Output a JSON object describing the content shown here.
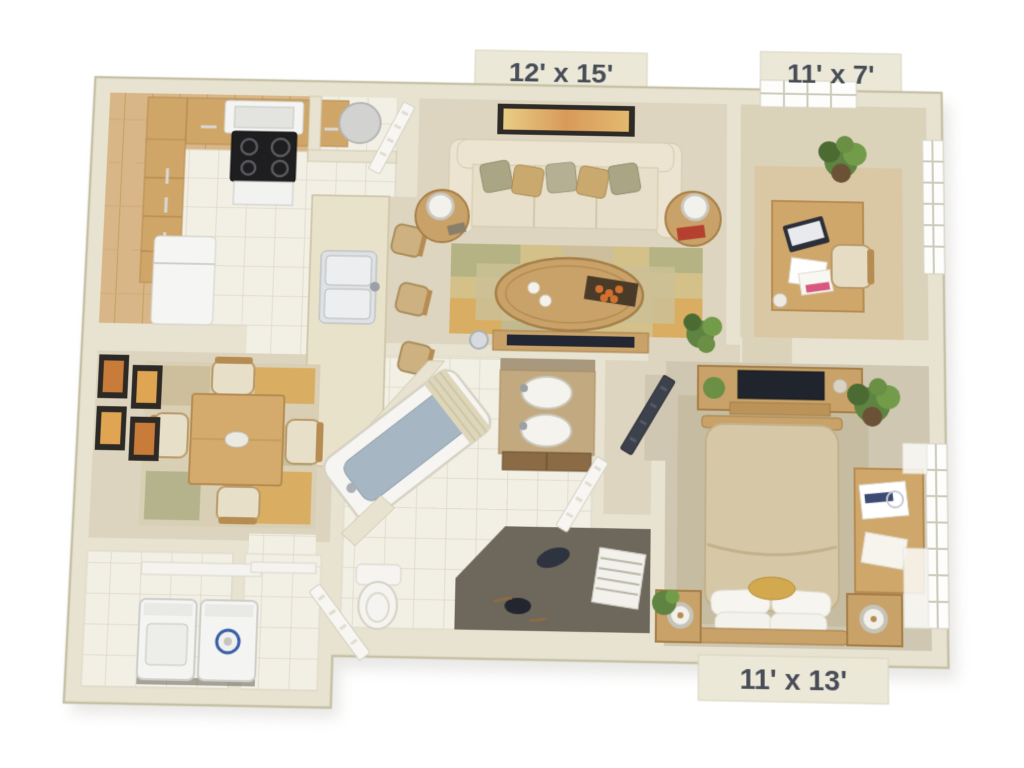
{
  "floorplan": {
    "type": "3d-apartment-floor-plan",
    "labels": {
      "living_room": "12' x 15'",
      "den": "11' x 7'",
      "bedroom": "11' x 13'"
    },
    "rooms": [
      "kitchen",
      "living-room",
      "den-office",
      "dining-room",
      "bathroom",
      "walk-in-closet",
      "bedroom",
      "laundry-room",
      "entry-hall"
    ],
    "colors": {
      "background": "#ffffff",
      "wall": "#e7e3d0",
      "wall_edge": "#c6c1a6",
      "carpet": "#ded5c0",
      "den_carpet": "#dbd2ba",
      "bedroom_carpet": "#cfc7b1",
      "kitchen_wood": "#d9b687",
      "tile": "#f2efe4",
      "rug_base": "#d3c189",
      "rug_gold": "#d9ae62",
      "rug_olive": "#b5b383",
      "closet_floor": "#6e675b",
      "sofa": "#ece4d0",
      "bed_comforter": "#d6c8a6",
      "wood_furniture": "#c9a269",
      "stove": "#1e1e20",
      "appliance": "#f4f4f2",
      "tub_water": "#a7b6c3",
      "tv": "#20242d",
      "plant": "#5f8340",
      "art_accent": "#c97b3a",
      "label_bg": "#ebe8d7",
      "label_text": "#474c57"
    }
  }
}
